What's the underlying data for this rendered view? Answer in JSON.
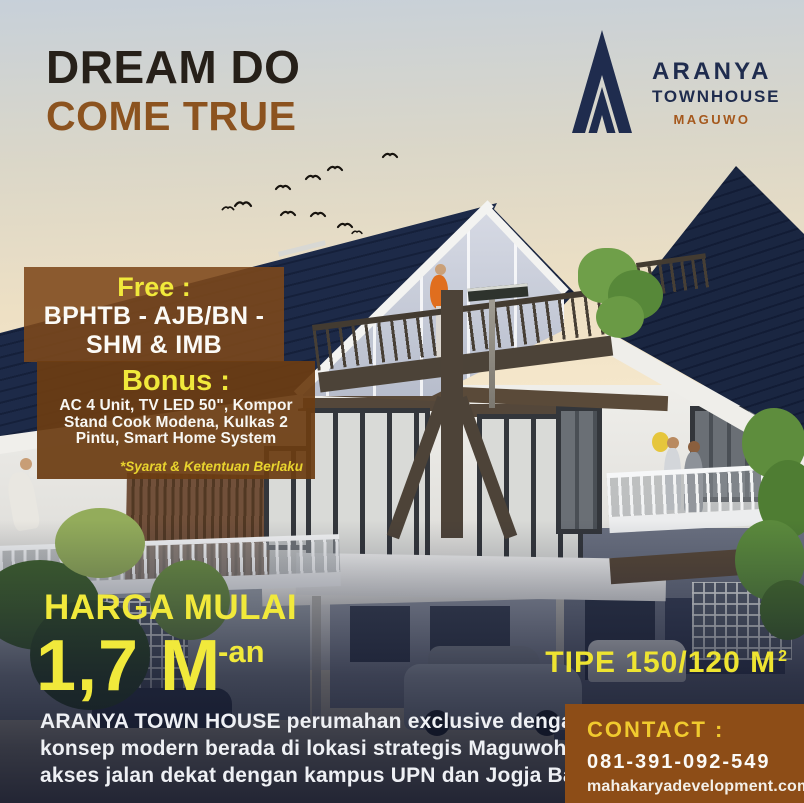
{
  "poster": {
    "title": {
      "line1": "DREAM DO",
      "line2": "COME TRUE"
    },
    "logo": {
      "brand": "ARANYA",
      "type": "TOWNHOUSE",
      "location": "MAGUWO"
    },
    "promo": {
      "free_label": "Free :",
      "free_lines": [
        "BPHTB - AJB/BN -",
        "SHM & IMB"
      ],
      "bonus_label": "Bonus :",
      "bonus_lines": [
        "AC 4 Unit, TV LED 50\", Kompor",
        "Stand Cook Modena, Kulkas 2",
        "Pintu, Smart Home System"
      ],
      "terms": "*Syarat & Ketentuan Berlaku"
    },
    "price": {
      "label": "HARGA MULAI",
      "value": "1,7 M",
      "suffix": "-an"
    },
    "unit_type": {
      "label": "TIPE 150/120 M",
      "sup": "2"
    },
    "description": {
      "line1": "ARANYA TOWN HOUSE perumahan exclusive dengan",
      "line2": "konsep modern berada di lokasi strategis Maguwoharjo,",
      "line3": "akses jalan dekat dengan kampus UPN dan Jogja Bay."
    },
    "contact": {
      "label": "CONTACT :",
      "phone": "081-391-092-549",
      "website": "mahakaryadevelopment.com"
    }
  },
  "colors": {
    "title_dark": "#262019",
    "accent_brown": "#8c531f",
    "brand_navy": "#1f2c4e",
    "logo_location_brown": "#a5581c",
    "promo_box_brown": "#7d481a",
    "bonus_box_brown": "#6c3c12",
    "contact_box_brown": "#8d4d17",
    "highlight_yellow": "#f1e93b",
    "contact_label_yellow": "#f0ca2e",
    "roof_navy": "#1b2846"
  }
}
